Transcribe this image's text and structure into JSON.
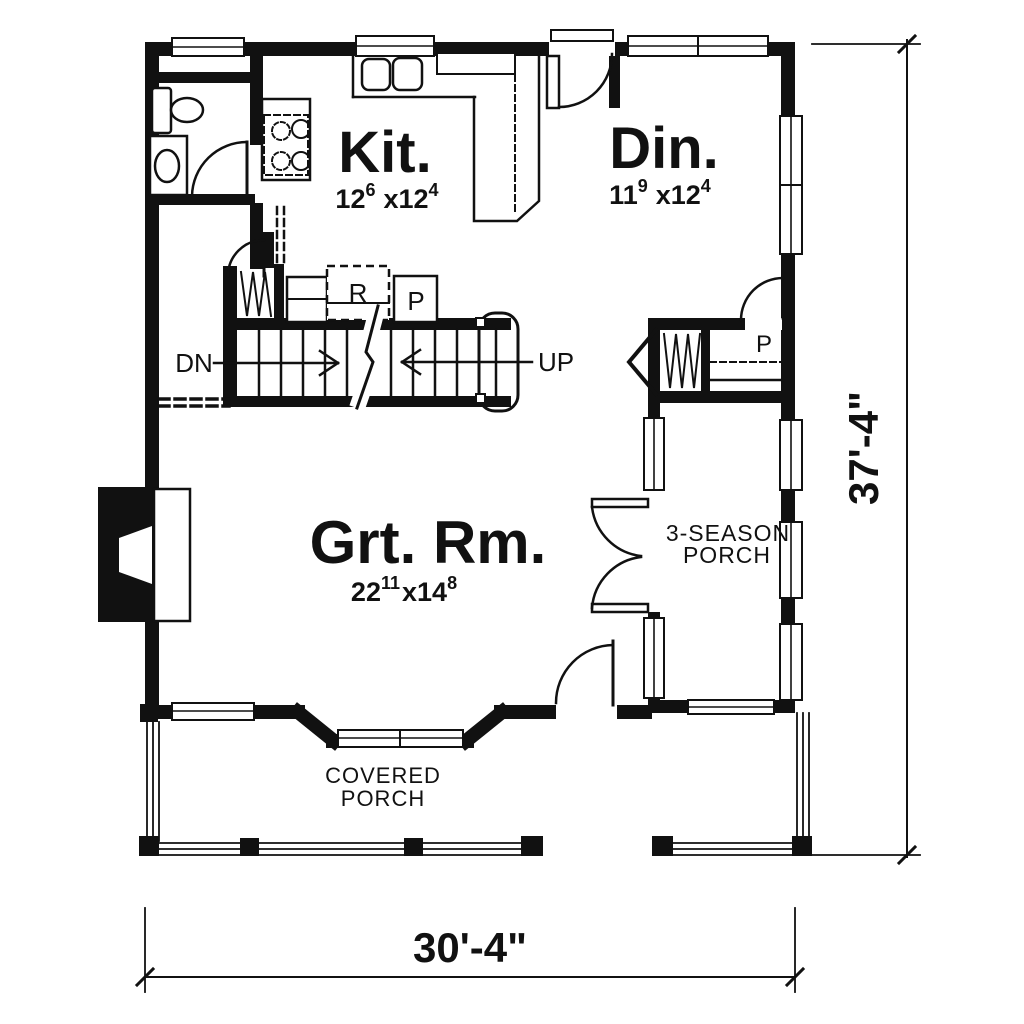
{
  "drawing": {
    "title": "First floor plan",
    "ink_color": "#111111",
    "paper_color": "#ffffff",
    "rooms": {
      "kitchen": {
        "name": "Kit.",
        "dim_a": "12",
        "dim_a_sup": "6",
        "dim_b": "x12",
        "dim_b_sup": "4"
      },
      "dining": {
        "name": "Din.",
        "dim_a": "11",
        "dim_a_sup": "9",
        "dim_b": "x12",
        "dim_b_sup": "4"
      },
      "great_room": {
        "name": "Grt. Rm.",
        "dim_a": "22",
        "dim_a_sup": "11",
        "dim_b": "x14",
        "dim_b_sup": "8"
      },
      "season_porch": {
        "line1": "3-SEASON",
        "line2": "PORCH"
      },
      "covered_porch": {
        "line1": "COVERED",
        "line2": "PORCH"
      }
    },
    "stairs": {
      "down": "DN",
      "up": "UP"
    },
    "fixtures": {
      "refrigerator": "R",
      "kitchen_pantry": "P",
      "hall_pantry": "P"
    },
    "dimensions": {
      "overall_depth": "37'-4\"",
      "overall_width": "30'-4\""
    }
  }
}
